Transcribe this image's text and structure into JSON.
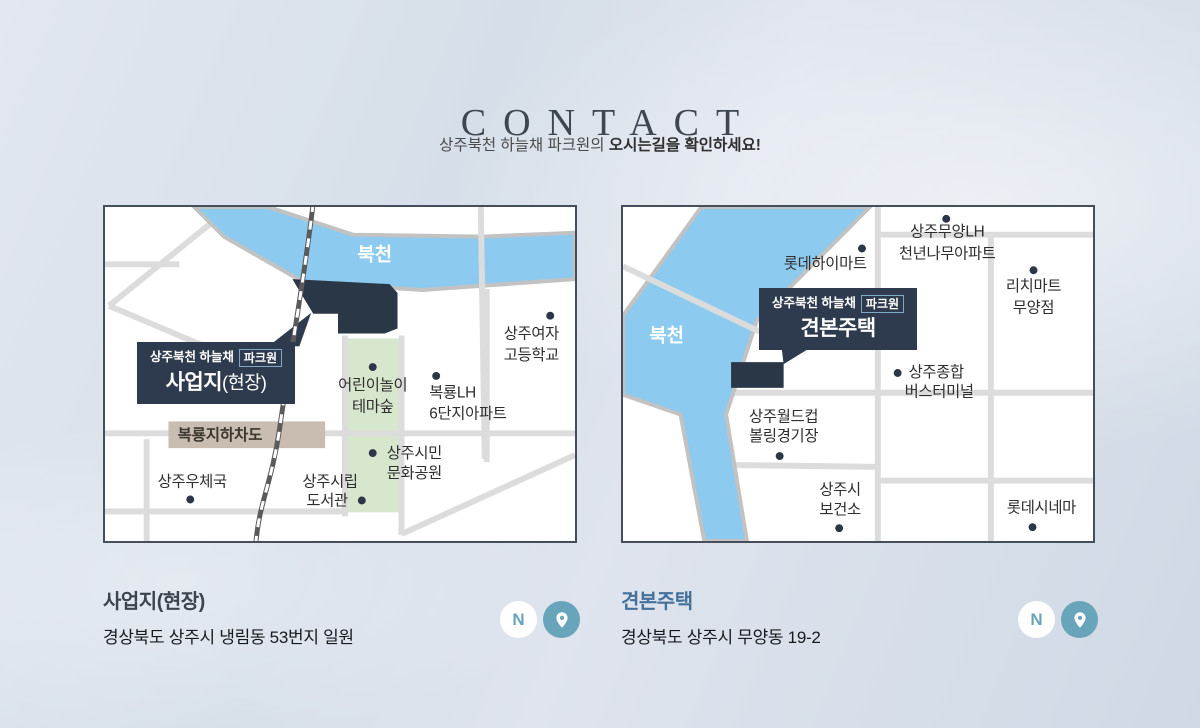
{
  "header": {
    "title": "CONTACT",
    "subtitle_normal": "상주북천 하늘채 파크원의 ",
    "subtitle_bold": "오시는길을 확인하세요!"
  },
  "brand": {
    "name": "상주북천 하늘채",
    "badge": "파크원"
  },
  "site_map": {
    "river_label": "북천",
    "callout_title": "사업지",
    "callout_suffix": "(현장)",
    "underpass_label": "복룡지하차도",
    "pois": [
      {
        "lines": [
          "상주여자",
          "고등학교"
        ]
      },
      {
        "lines": [
          "어린이놀이",
          "테마숲"
        ]
      },
      {
        "lines": [
          "복룡LH",
          "6단지아파트"
        ]
      },
      {
        "lines": [
          "상주우체국"
        ]
      },
      {
        "lines": [
          "상주시립",
          "도서관"
        ]
      },
      {
        "lines": [
          "상주시민",
          "문화공원"
        ]
      }
    ]
  },
  "model_map": {
    "river_label": "북천",
    "callout_title": "견본주택",
    "pois": [
      {
        "lines": [
          "롯데하이마트"
        ]
      },
      {
        "lines": [
          "상주무양LH",
          "천년나무아파트"
        ]
      },
      {
        "lines": [
          "리치마트",
          "무양점"
        ]
      },
      {
        "lines": [
          "상주종합",
          "버스터미널"
        ]
      },
      {
        "lines": [
          "상주월드컵",
          "볼링경기장"
        ]
      },
      {
        "lines": [
          "상주시",
          "보건소"
        ]
      },
      {
        "lines": [
          "롯데시네마"
        ]
      }
    ]
  },
  "site_info": {
    "heading": "사업지(현장)",
    "address": "경상북도 상주시 냉림동 53번지 일원"
  },
  "model_info": {
    "heading": "견본주택",
    "address": "경상북도 상주시 무양동 19-2"
  },
  "links": {
    "naver_label": "N"
  },
  "colors": {
    "accent_teal": "#68a4ba",
    "navy": "#2e3b4e",
    "river_blue": "#8ccaf0",
    "park_green": "#d7e7cd",
    "underpass_beige": "#c9bcb1",
    "road_gray": "#dcdcdc",
    "model_heading_blue": "#44719a"
  }
}
